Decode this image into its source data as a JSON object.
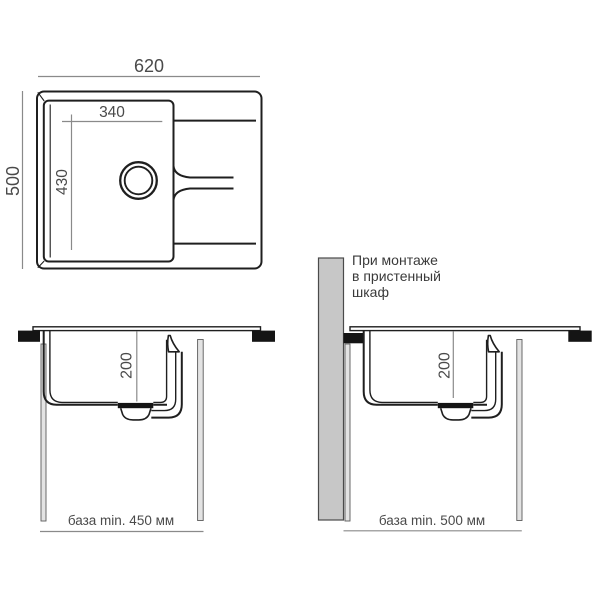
{
  "colors": {
    "background": "#ffffff",
    "line": "#1f1f1f",
    "dimension_line": "#8a8a8a",
    "label_text": "#4a4a4a",
    "note_text": "#3a3a3a",
    "wall_fill": "#c7c7c7",
    "panel_fill": "#e3e3e3",
    "panel_stroke": "#5a5a5a",
    "clamp_fill": "#141414"
  },
  "top_view": {
    "overall_width_mm": "620",
    "overall_depth_mm": "500",
    "bowl_width_mm": "340",
    "bowl_length_mm": "430"
  },
  "front_view_standard": {
    "bowl_depth_mm": "200",
    "base_label": "база min. 450 мм"
  },
  "front_view_wall_cabinet": {
    "bowl_depth_mm": "200",
    "base_label": "база min. 500 мм",
    "note_lines": [
      "При монтаже",
      "в пристенный",
      "шкаф"
    ]
  }
}
